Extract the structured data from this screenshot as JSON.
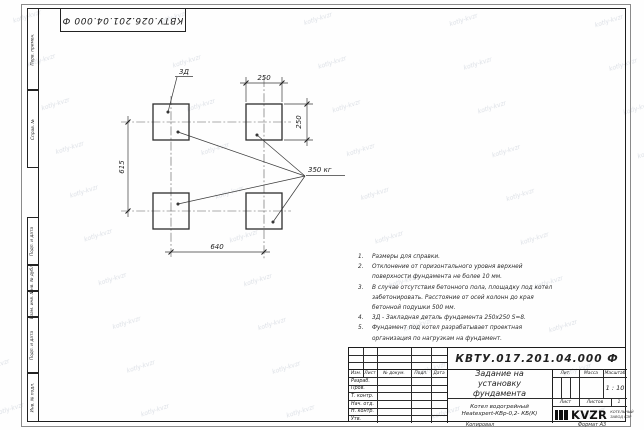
{
  "page": {
    "top_stamp": "КВТУ.026.201.04.000 Ф",
    "watermark": "kotly-kvzr",
    "footer_copied": "Копировал",
    "footer_format": "Формат А3"
  },
  "margin": {
    "labels": [
      "Перв. примен.",
      "Справ. №",
      "Подп. и дата",
      "Инв. № дубл.",
      "Взам. инв. №",
      "Подп. и дата",
      "Инв. № подл."
    ]
  },
  "drawing": {
    "pad_label": "3Д",
    "load_label": "350 кг",
    "dim_top": "250",
    "dim_right": "250",
    "dim_left": "615",
    "dim_bottom": "640"
  },
  "notes": [
    {
      "num": "1.",
      "text": "Размеры для справки."
    },
    {
      "num": "2.",
      "text": "Отклонение от горизонтального уровня верхней поверхности фундамента не более 10 мм."
    },
    {
      "num": "3.",
      "text": "В случае отсутствия бетонного пола, площадку под котел забетонировать. Расстояние от осей колонн до края бетонной подушки 500 мм."
    },
    {
      "num": "4.",
      "text": "3Д - Закладная деталь фундамента 250х250 S=8."
    },
    {
      "num": "5.",
      "text": "Фундамент под котел разрабатывает проектная организация по нагрузкам на фундамент."
    }
  ],
  "title_block": {
    "doc_number": "КВТУ.017.201.04.000 Ф",
    "title": "Задание на установку фундамента",
    "product_line1": "Котел водогрейный",
    "product_line2": "Heatexpert-КВр-0,2- КБ(К)",
    "header_cols": [
      "Изм.",
      "Лист",
      "№ докум.",
      "Подп.",
      "Дата"
    ],
    "sign_rows": [
      "Разраб.",
      "Пров.",
      "Т. контр.",
      "Нач. отд.",
      "Н. контр.",
      "Утв."
    ],
    "lit_label": "Лит.",
    "mass_label": "Масса",
    "scale_label": "Масштаб",
    "scale_value": "1 : 10",
    "sheet_label": "Лист",
    "sheets_label": "Листов",
    "sheets_value": "1",
    "logo_word": "KVZR",
    "company_line1": "КОТЕЛЬНЫЙ",
    "company_line2": "ЗАВОД КЗР"
  }
}
